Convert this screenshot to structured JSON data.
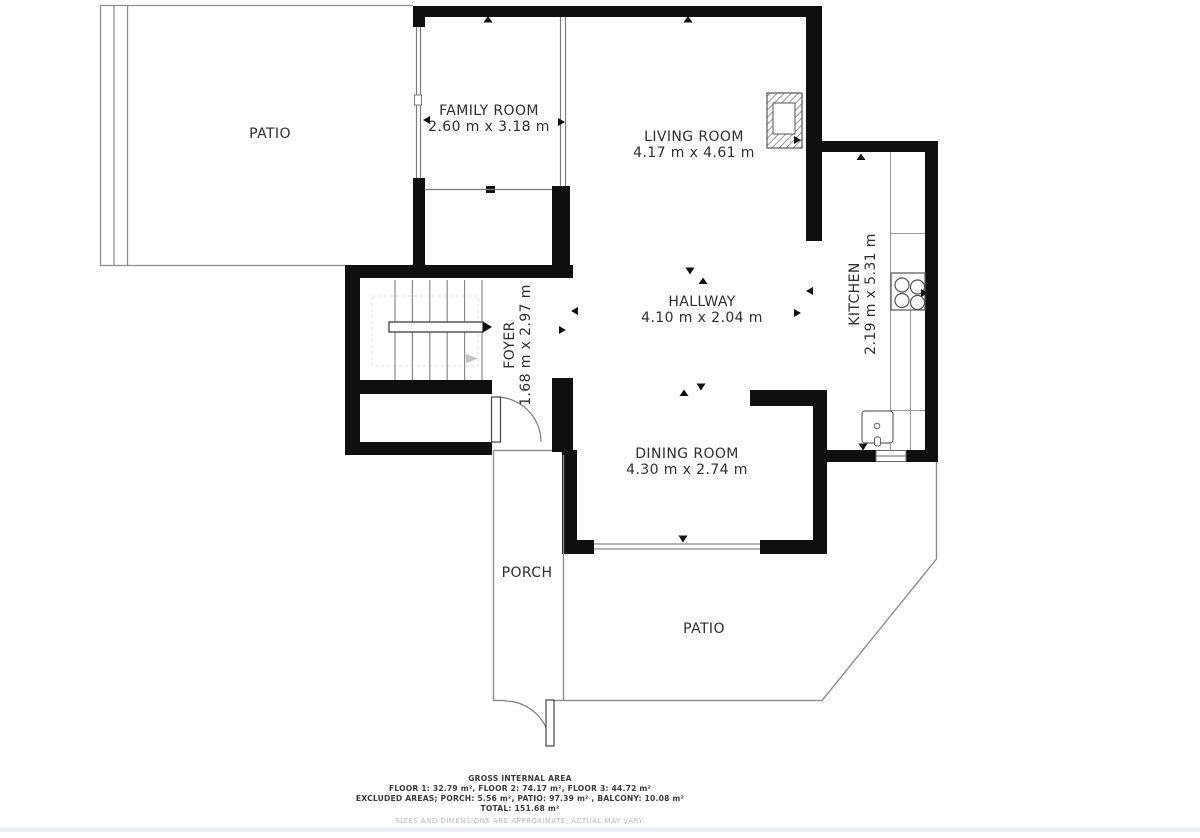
{
  "plan": {
    "rooms": {
      "patio_top": {
        "label": "PATIO"
      },
      "family_room": {
        "label": "FAMILY ROOM",
        "dims": "2.60 m x 3.18 m"
      },
      "living_room": {
        "label": "LIVING ROOM",
        "dims": "4.17 m x 4.61 m"
      },
      "hallway": {
        "label": "HALLWAY",
        "dims": "4.10 m x 2.04 m"
      },
      "kitchen": {
        "label": "KITCHEN",
        "dims": "2.19 m x 5.31 m"
      },
      "foyer": {
        "label": "FOYER",
        "dims": "1.68 m x 2.97 m"
      },
      "dining_room": {
        "label": "DINING ROOM",
        "dims": "4.30 m x 2.74 m"
      },
      "porch": {
        "label": "PORCH"
      },
      "patio_bottom": {
        "label": "PATIO"
      }
    },
    "footer": {
      "title": "GROSS INTERNAL AREA",
      "floors": "FLOOR 1: 32.79 m², FLOOR 2: 74.17 m², FLOOR 3: 44.72 m²",
      "excluded": "EXCLUDED AREAS; PORCH: 5.56 m², PATIO: 97.39 m² , BALCONY: 10.08 m²",
      "total": "TOTAL: 151.68 m²",
      "disclaimer": "SIZES AND DIMENSIONS ARE APPROXIMATE, ACTUAL MAY VARY."
    },
    "colors": {
      "wall": "#0f0f0f",
      "thin_line": "#7d7d7d",
      "outline_line": "#8f8f8f",
      "label_text": "#2e2e2e",
      "muted_text": "#b6bbc1"
    }
  }
}
